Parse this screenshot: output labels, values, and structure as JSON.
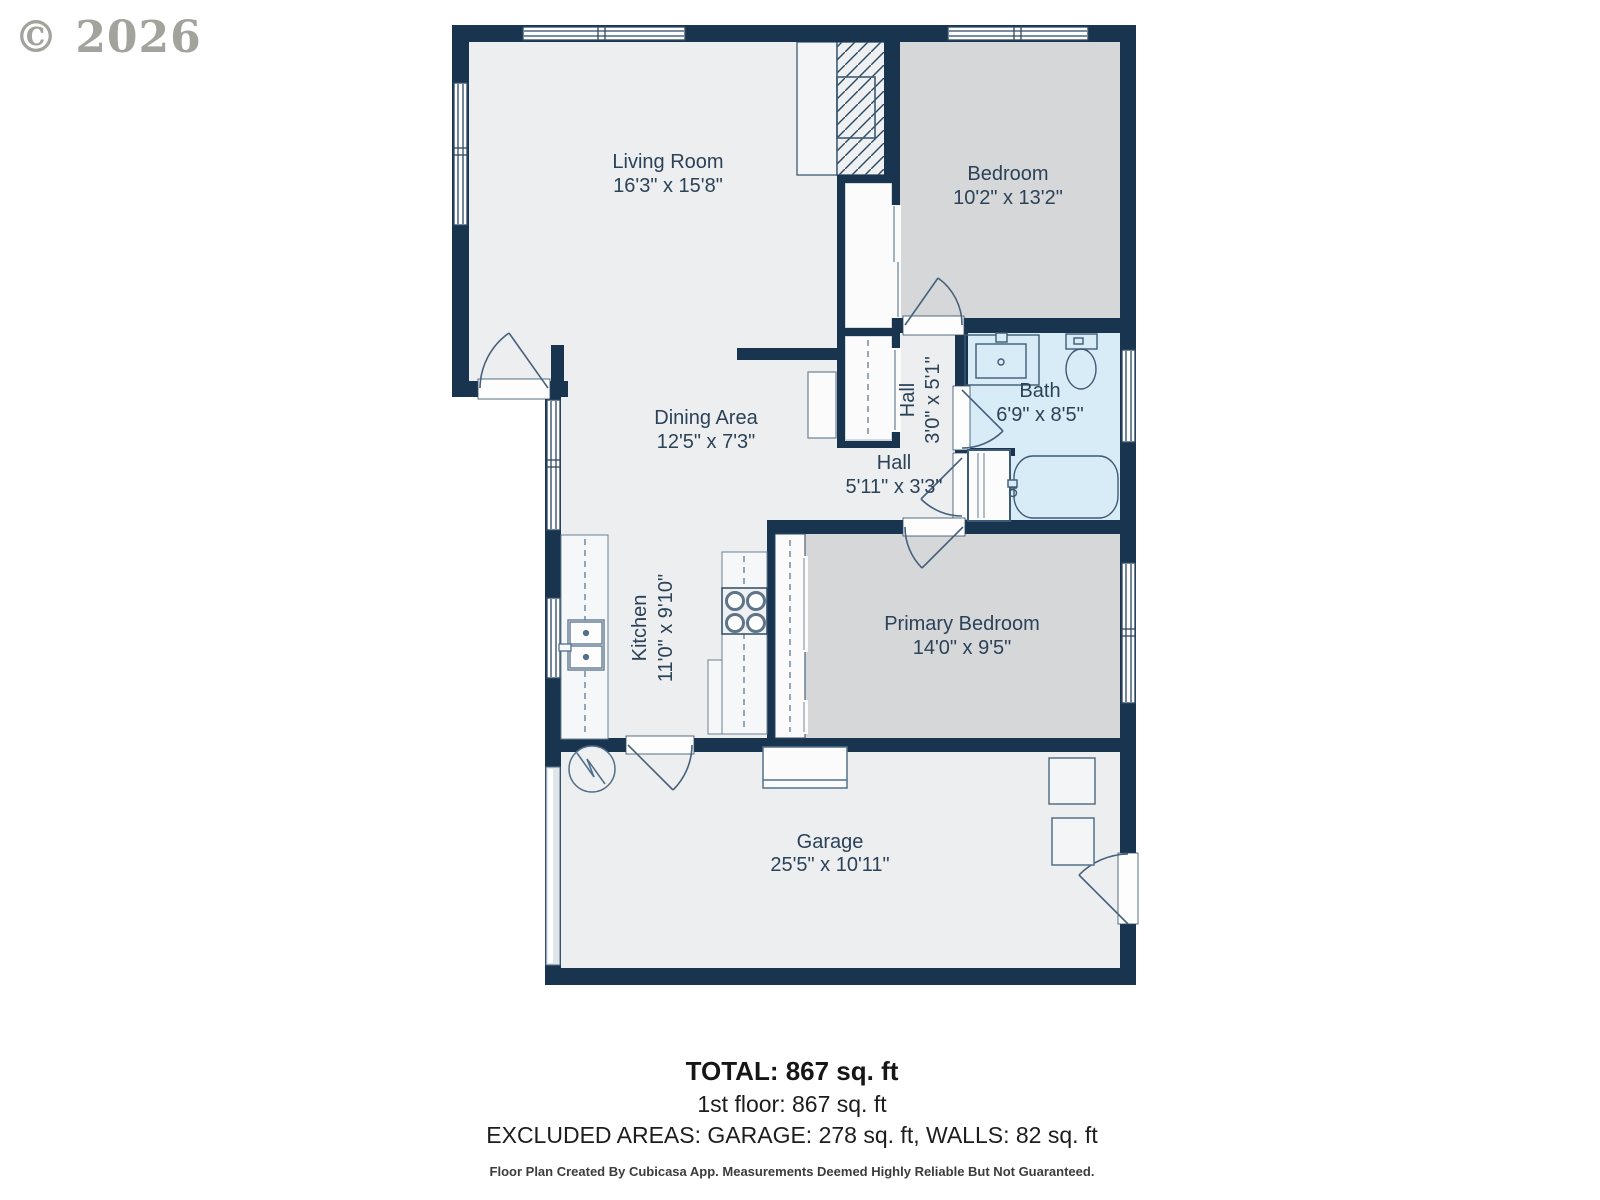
{
  "copyright": "© 2026",
  "rooms": {
    "living": {
      "name": "Living Room",
      "dims": "16'3\" x 15'8\""
    },
    "bedroom": {
      "name": "Bedroom",
      "dims": "10'2\" x 13'2\""
    },
    "bath": {
      "name": "Bath",
      "dims": "6'9\" x 8'5\""
    },
    "hall_upper": {
      "name": "Hall",
      "dims": "3'0\" x 5'1\""
    },
    "hall_lower": {
      "name": "Hall",
      "dims": "5'11\" x 3'3\""
    },
    "dining": {
      "name": "Dining Area",
      "dims": "12'5\" x 7'3\""
    },
    "kitchen": {
      "name": "Kitchen",
      "dims": "11'0\" x 9'10\""
    },
    "primary": {
      "name": "Primary Bedroom",
      "dims": "14'0\" x 9'5\""
    },
    "garage": {
      "name": "Garage",
      "dims": "25'5\" x 10'11\""
    }
  },
  "summary": {
    "total": "TOTAL: 867 sq. ft",
    "first_floor": "1st floor: 867 sq. ft",
    "excluded": "EXCLUDED AREAS: GARAGE: 278 sq. ft, WALLS: 82 sq. ft"
  },
  "disclaimer": "Floor Plan Created By Cubicasa App. Measurements Deemed Highly Reliable But Not Guaranteed.",
  "colors": {
    "wall": "#18344f",
    "floor": "#edeeef",
    "bedroom_floor": "#d6d7d9",
    "bath_floor": "#d8ecf8",
    "fixture_stroke": "#54708a",
    "label": "#2b4257"
  },
  "icons": [
    "fireplace-icon",
    "wardrobe-icon",
    "fridge-icon",
    "stove-icon",
    "kitchen-sink-icon",
    "bathroom-sink-icon",
    "toilet-icon",
    "bathtub-icon",
    "linen-closet-icon",
    "water-heater-icon",
    "furnace-icon",
    "garage-door-icon",
    "door-swing-icon",
    "window-icon"
  ]
}
